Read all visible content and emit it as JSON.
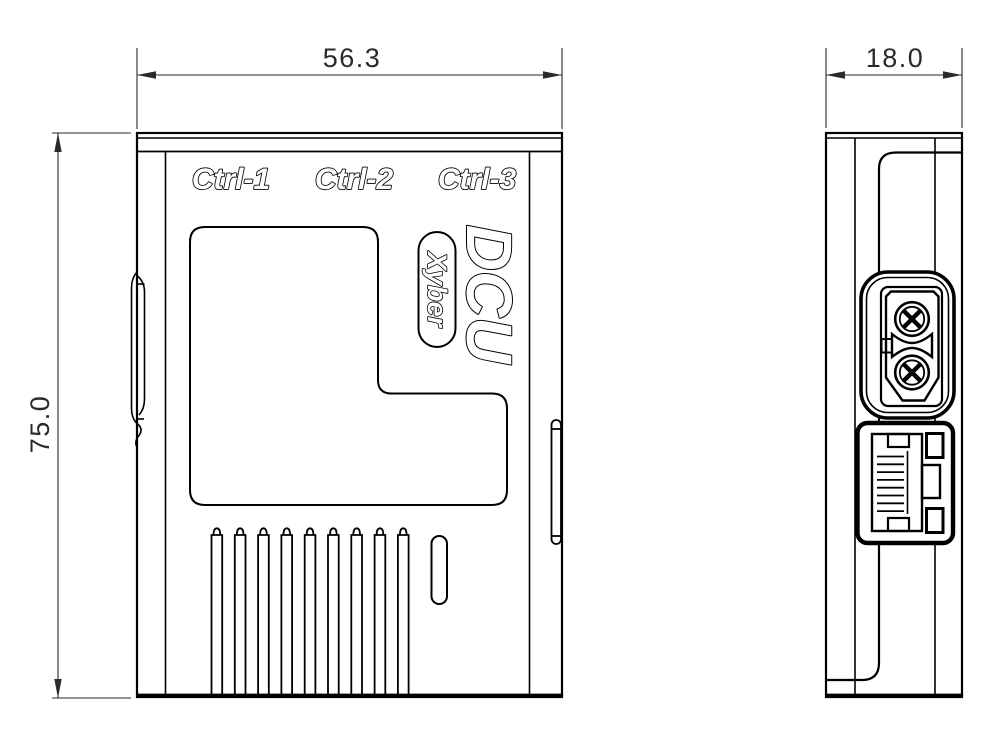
{
  "front_view": {
    "width_dim": "56.3",
    "height_dim": "75.0",
    "port_labels": [
      "Ctrl-1",
      "Ctrl-2",
      "Ctrl-3"
    ],
    "product_name": "DCU",
    "brand_badge": "Xyber",
    "vent_slot_count": 9
  },
  "side_view": {
    "depth_dim": "18.0",
    "rj45_pin_count": 8
  },
  "colors": {
    "line": "#000000",
    "dim": "#2a2a2a",
    "background": "#ffffff"
  }
}
